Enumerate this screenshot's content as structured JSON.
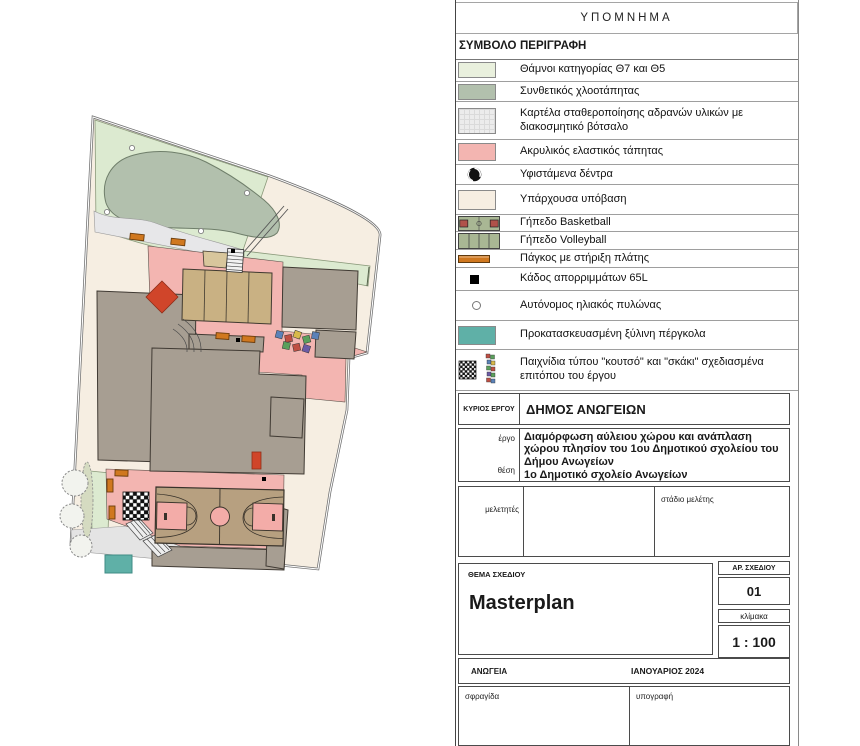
{
  "legend": {
    "title": "ΥΠΟΜΝΗΜΑ",
    "col_symbol": "ΣΥΜΒΟΛΟ",
    "col_desc": "ΠΕΡΙΓΡΑΦΗ",
    "rows": [
      {
        "icon": "shrubs-swatch",
        "label": "Θάμνοι κατηγορίας Θ7 και Θ5"
      },
      {
        "icon": "turf-swatch",
        "label": "Συνθετικός χλοοτάπητας"
      },
      {
        "icon": "gravel-swatch",
        "label": "Καρτέλα σταθεροποίησης αδρανών υλικών με διακοσμητικό βότσαλο"
      },
      {
        "icon": "acrylic-swatch",
        "label": "Ακρυλικός ελαστικός τάπητας"
      },
      {
        "icon": "tree-icon",
        "label": "Υφιστάμενα  δέντρα"
      },
      {
        "icon": "substrate-swatch",
        "label": "Υπάρχουσα υπόβαση"
      },
      {
        "icon": "basketball-court-icon",
        "label": "Γήπεδο Basketball"
      },
      {
        "icon": "volleyball-court-icon",
        "label": "Γήπεδο Volleyball"
      },
      {
        "icon": "bench-icon",
        "label": "Πάγκος με στήριξη πλάτης"
      },
      {
        "icon": "bin-icon",
        "label": "Κάδος απορριμμάτων 65L"
      },
      {
        "icon": "solar-pylon-icon",
        "label": "Αυτόνομος ηλιακός πυλώνας"
      },
      {
        "icon": "pergola-swatch",
        "label": "Προκατασκευασμένη ξύλινη πέργκολα"
      },
      {
        "icon": "games-icon",
        "label": "Παιχνίδια τύπου \"κουτσό\" και \"σκάκι\" σχεδιασμένα επιτόπου του έργου"
      }
    ]
  },
  "titleblock": {
    "owner_label": "ΚΥΡΙΟΣ ΕΡΓΟΥ",
    "owner": "ΔΗΜΟΣ ΑΝΩΓΕΙΩΝ",
    "project_label": "έργο",
    "project": "Διαμόρφωση αύλειου χώρου και ανάπλαση χώρου πλησίον του 1ου Δημοτικού σχολείου του Δήμου Ανωγείων",
    "location_label": "θέση",
    "location": "1ο Δημοτικό σχολείο Ανωγείων",
    "designers_label": "μελετητές",
    "stage_label": "στάδιο μελέτης",
    "subject_label": "ΘΕΜΑ ΣΧΕΔΙΟΥ",
    "subject": "Masterplan",
    "drawing_no_label": "ΑΡ. ΣΧΕΔΙΟΥ",
    "drawing_no": "01",
    "scale_label": "κλίμακα",
    "scale": "1 : 100",
    "city": "ΑΝΩΓΕΙΑ",
    "date": "ΙΑΝΟΥΑΡΙΟΣ 2024",
    "stamp_label": "σφραγίδα",
    "signature_label": "υπογραφή"
  },
  "plan": {
    "colors": {
      "shrubs": "#e9f0dd",
      "synthetic_turf": "#b2c0ad",
      "gravel_panel": "#ececec",
      "acrylic": "#f3b5b1",
      "existing_substrate": "#f6eee2",
      "court_green": "#a9b794",
      "court_tan": "#b7a080",
      "building": "#a79e92",
      "bench_orange": "#d0781f",
      "pergola_teal": "#5fb0a7",
      "red_feature": "#d0452a"
    }
  }
}
